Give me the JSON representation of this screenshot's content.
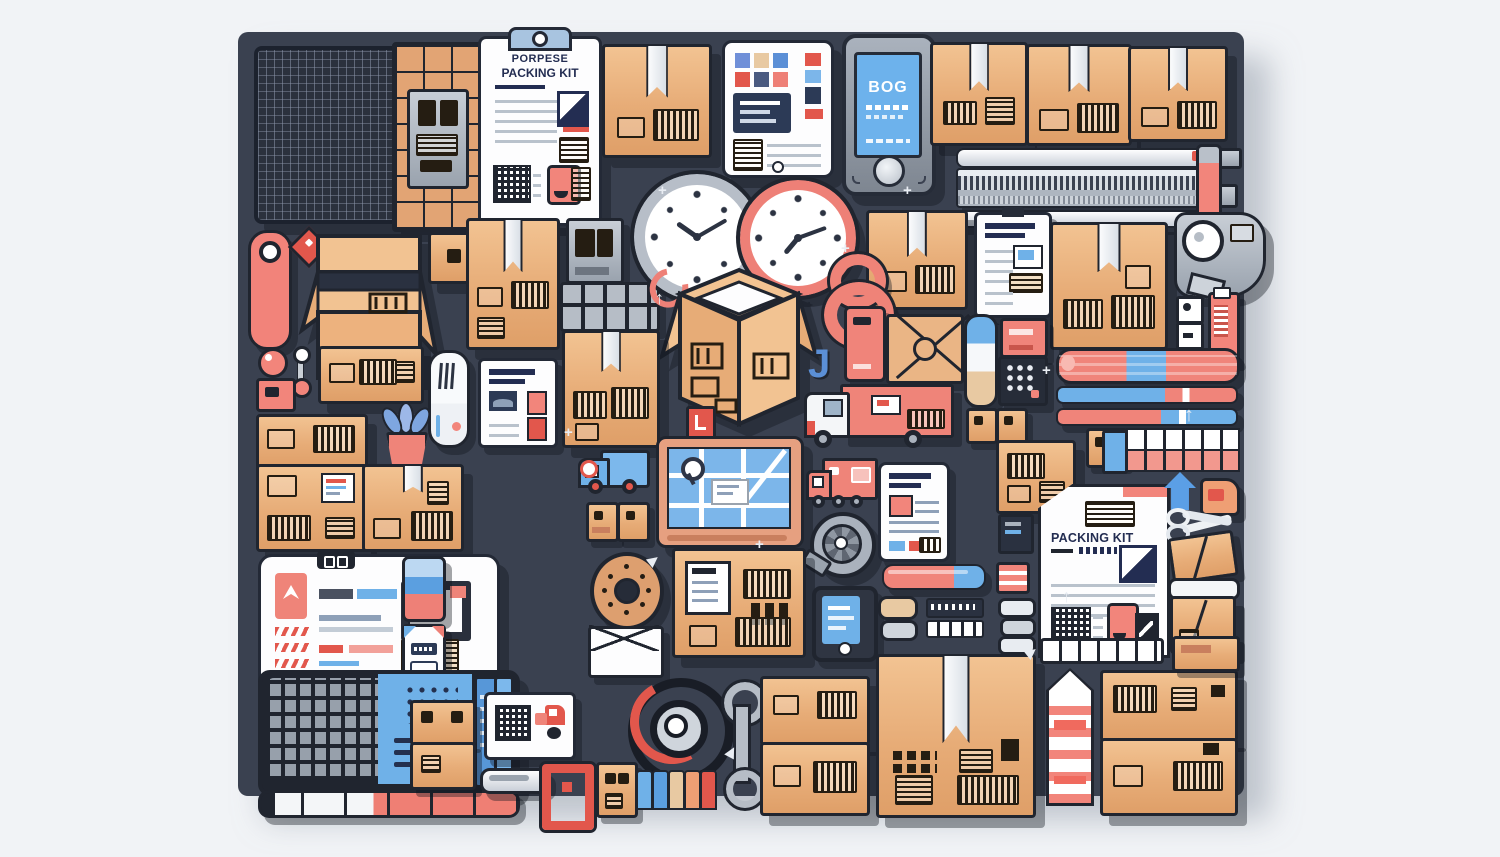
{
  "scene": {
    "description": "Flat vector illustration collage of packing and shipping objects arranged on a dark slate board",
    "background_color": "#f1f3f6",
    "board_color": "#3a4150"
  },
  "texts": {
    "clipboard_title_line1": "PORPESE",
    "clipboard_title_line2": "PACKING KIT",
    "phone_screen_title": "BOG",
    "packing_doc_title": "PACKING KIT"
  },
  "icons": {
    "plus": "+",
    "arrow_up": "↑",
    "pointer": "▶",
    "letter_j": "J"
  },
  "palette": {
    "cardboard": "#eab585",
    "cardboard_dark": "#df9f68",
    "outline": "#20252f",
    "salmon": "#f0796e",
    "red": "#e2574c",
    "blue": "#6fb1e8",
    "blue_mid": "#5b8fd6",
    "navy": "#232d52",
    "white": "#ffffff",
    "gray": "#aab2bd"
  },
  "depicted_objects": [
    "wire mesh panel",
    "brick pattern panel",
    "clipboard packing list",
    "cardboard boxes",
    "taped parcels",
    "open cardboard box",
    "mosaic dashboard tablet",
    "smartphone",
    "wall clock",
    "alarm clock",
    "zipper tape strips",
    "marker pen",
    "capsule",
    "thermometer capsule",
    "mini clipboard",
    "tape dispenser",
    "figure-eight tape",
    "envelope parcel",
    "delivery truck",
    "toy trucks",
    "road map tablet",
    "spool wheel",
    "document tablet",
    "calculator keypad",
    "pill capsule",
    "canister",
    "striped tape tubes",
    "tile grid",
    "potted plant",
    "checklist card",
    "eraser",
    "donut wheel",
    "bottle",
    "envelope",
    "phone",
    "keyboard",
    "measuring ruler",
    "QR shipping card",
    "red bracket",
    "cable coil",
    "wrench",
    "color tabs",
    "packing kit document",
    "blue house marker",
    "folder",
    "scissors",
    "flattened boxes",
    "striped rocket tube",
    "barcode labels"
  ]
}
